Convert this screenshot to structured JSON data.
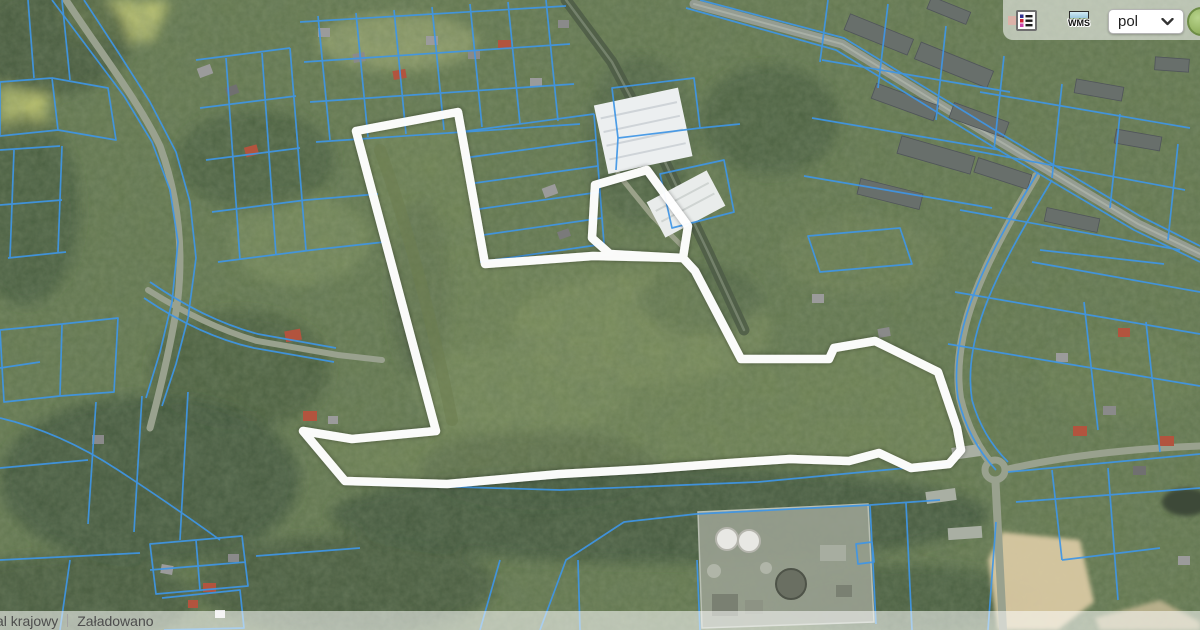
{
  "toolbar": {
    "wms_label": "WMS",
    "language_value": "pol"
  },
  "status_bar": {
    "left_text": "al krajowy",
    "right_text": "Załadowano"
  },
  "overlay": {
    "main_outline_points": "356,131 458,112 485,264 593,256 683,258 695,271 741,359 829,359 834,348 875,341 938,372 957,428 961,450 949,464 911,468 879,453 849,461 790,459 730,463 650,469 560,474 447,484 345,481 303,431 352,439 436,431",
    "north_outline_points": "647,170 688,226 683,258 610,254 592,238 595,185"
  },
  "colors": {
    "highlight-outline": "#ffffff",
    "parcel-lines": "#3f96e6",
    "panel-bg": "rgba(255,255,255,0.55)",
    "status-bar-bg": "rgba(255,255,255,0.55)",
    "status-text": "#4d4d4d"
  }
}
